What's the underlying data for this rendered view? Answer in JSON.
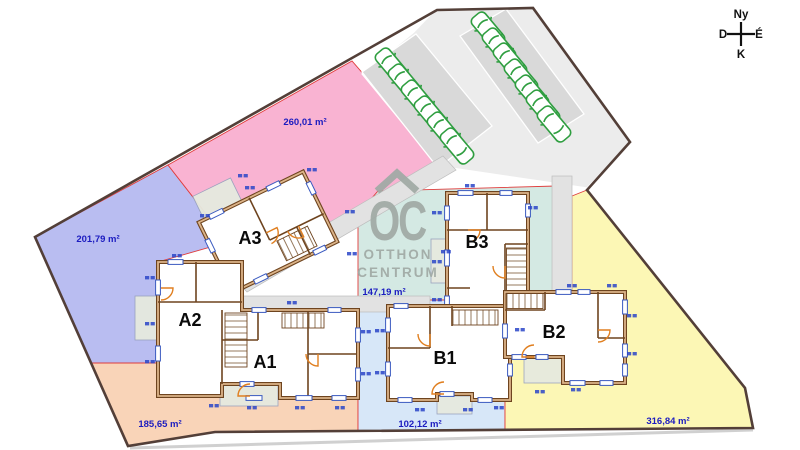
{
  "plan": {
    "plots": [
      {
        "id": "pink",
        "area_label": "260,01 m²"
      },
      {
        "id": "blue",
        "area_label": "201,79 m²"
      },
      {
        "id": "orange",
        "area_label": "185,65 m²"
      },
      {
        "id": "teal",
        "area_label": "147,19 m²"
      },
      {
        "id": "lightblue",
        "area_label": "102,12 m²"
      },
      {
        "id": "yellow",
        "area_label": "316,84 m²"
      }
    ],
    "units": [
      {
        "id": "A3",
        "label": "A3"
      },
      {
        "id": "A2",
        "label": "A2"
      },
      {
        "id": "A1",
        "label": "A1"
      },
      {
        "id": "B3",
        "label": "B3"
      },
      {
        "id": "B1",
        "label": "B1"
      },
      {
        "id": "B2",
        "label": "B2"
      }
    ],
    "parking": {
      "cars_left_row": 6,
      "cars_right_row": 7
    }
  },
  "compass": {
    "top": "Ny",
    "left": "D",
    "right": "É",
    "bottom": "K"
  },
  "watermark": {
    "monogram": "OC",
    "line1": "OTTHON",
    "line2": "CENTRUM"
  },
  "colors": {
    "plot_pink": "#f9b3d2",
    "plot_blue": "#b9bdf1",
    "plot_orange": "#f9d4b8",
    "plot_teal": "#d4e9e3",
    "plot_lightblue": "#d7e7f8",
    "plot_yellow": "#fcf7b5",
    "area_label_text": "#1c1cc0",
    "unit_label_text": "#0a0a0a",
    "boundary_line": "#533f38",
    "lot_line_red": "#e03c3c",
    "wall_brown": "#6e441f",
    "door_orange": "#e07f20",
    "window_blue": "#3a5ac0",
    "car_green": "#2f9e40",
    "paving_gray": "#ececec",
    "watermark_gray": "#a0aaa5"
  }
}
